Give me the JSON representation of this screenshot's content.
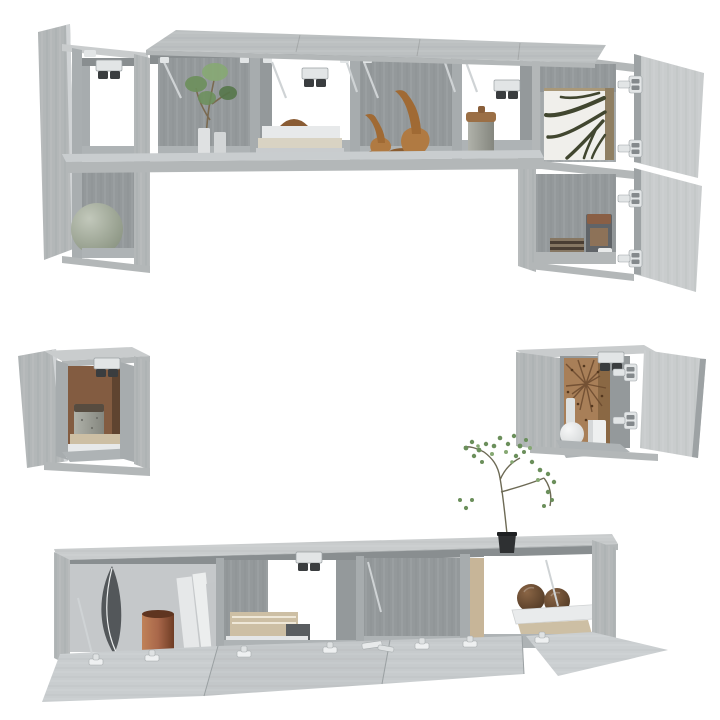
{
  "image": {
    "kind": "product-photo",
    "subject": "6-piece wall-mounted TV cabinet set, grey sonoma wood, doors open, styled with decor",
    "background": "#ffffff"
  },
  "colors": {
    "background": "#ffffff",
    "wood-top": "#bcc0c1",
    "wood-light": "#c9cccd",
    "wood-mid": "#b3b7b8",
    "wood-dark": "#94999b",
    "wood-side": "#a7acae",
    "wood-edge": "#8a8f91",
    "ceiling": "#898e90",
    "floor": "#aeb3b5",
    "brown-panel": "#835c41",
    "tan-panel": "#a87f58",
    "copper": "#a9674a",
    "wood-figure": "#b07a42",
    "ball-brown": "#6e4e37",
    "plant-green": "#6b8f5b",
    "plant-dark": "#55774a",
    "plant-light": "#86a873",
    "lamp-grey": "#a9b0a5",
    "metal": "#e2e5e6",
    "metal-dark": "#84898c",
    "feather": "#53575a",
    "book-white": "#e7e9ea",
    "book-beige": "#cdbfa4",
    "book-dark": "#595d60",
    "pot-black": "#2e3032",
    "leaf-art": "#41462f"
  },
  "objects": {
    "top_wall_unit": [
      "open-top-flap-doors",
      "left-tall-cabinet",
      "horizontal-4-compartment-cabinet",
      "right-tall-cabinet"
    ],
    "top_unit_decor": [
      "potted-plant",
      "pair-of-vases",
      "book-stack",
      "wooden-bowl",
      "wooden-bird-figurines",
      "lidded-jar",
      "ball-lamp",
      "leaf-art-panel",
      "canister",
      "striped-box"
    ],
    "mid_left_cube": [
      "open-door",
      "brown-back-panel",
      "stone-jar",
      "magazine-stack"
    ],
    "mid_right_cube": [
      "open-door",
      "sunburst-back-panel",
      "round-vase",
      "cylinder-vase",
      "glass-bottle"
    ],
    "bottom_tv_bench": [
      "open-flap-doors",
      "feather-art",
      "copper-vase",
      "leaning-books",
      "stacked-books",
      "wooden-spheres",
      "sapling-in-black-pot"
    ],
    "hardware": [
      "concealed-hinges",
      "gas-lift-stays",
      "wall-mount-brackets"
    ]
  }
}
